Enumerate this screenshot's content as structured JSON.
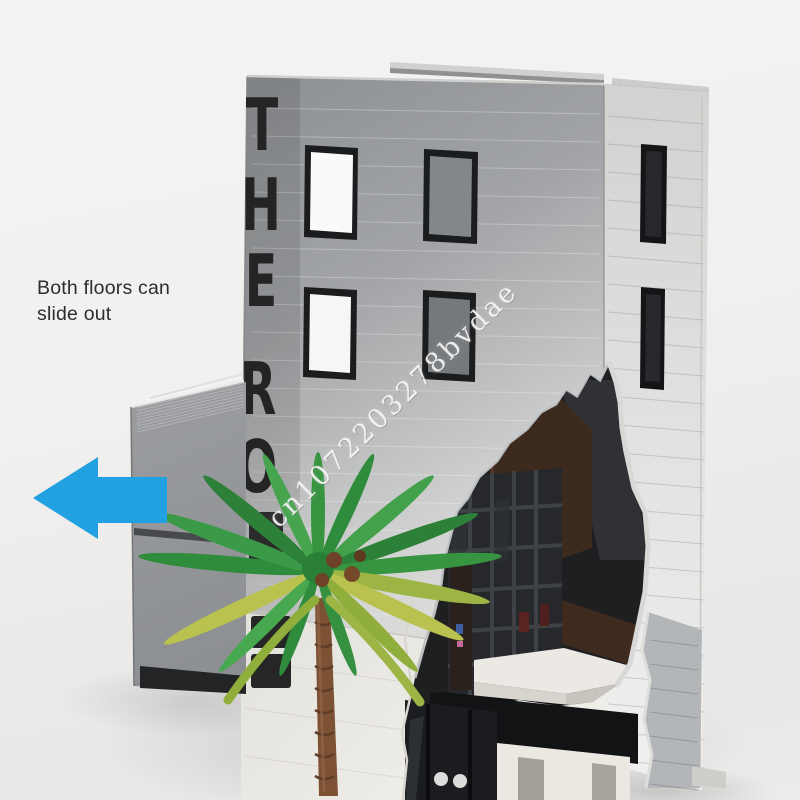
{
  "annotation": {
    "line1": "Both floors can",
    "line2": "slide out"
  },
  "watermark": {
    "text": "cn1072203278bvdae"
  },
  "building_sign": {
    "visible_letters": [
      "T",
      "H",
      "E",
      "R",
      "O"
    ]
  },
  "icons": {
    "slide_direction": "left-block-arrow"
  },
  "palette": {
    "arrow_blue": "#21a1e1",
    "background": "#f1f0ee",
    "brick_gray_front": "#9b9ea1",
    "brick_light_side": "#e9e8e6",
    "sign_black": "#242424",
    "interior_dark": "#1d1f21",
    "interior_brown": "#3d2a1f",
    "palm_green": "#3a9a47",
    "palm_yellow_green": "#b9c24e",
    "trunk_brown": "#7c5134",
    "annotation_text": "#2d2d2d"
  }
}
